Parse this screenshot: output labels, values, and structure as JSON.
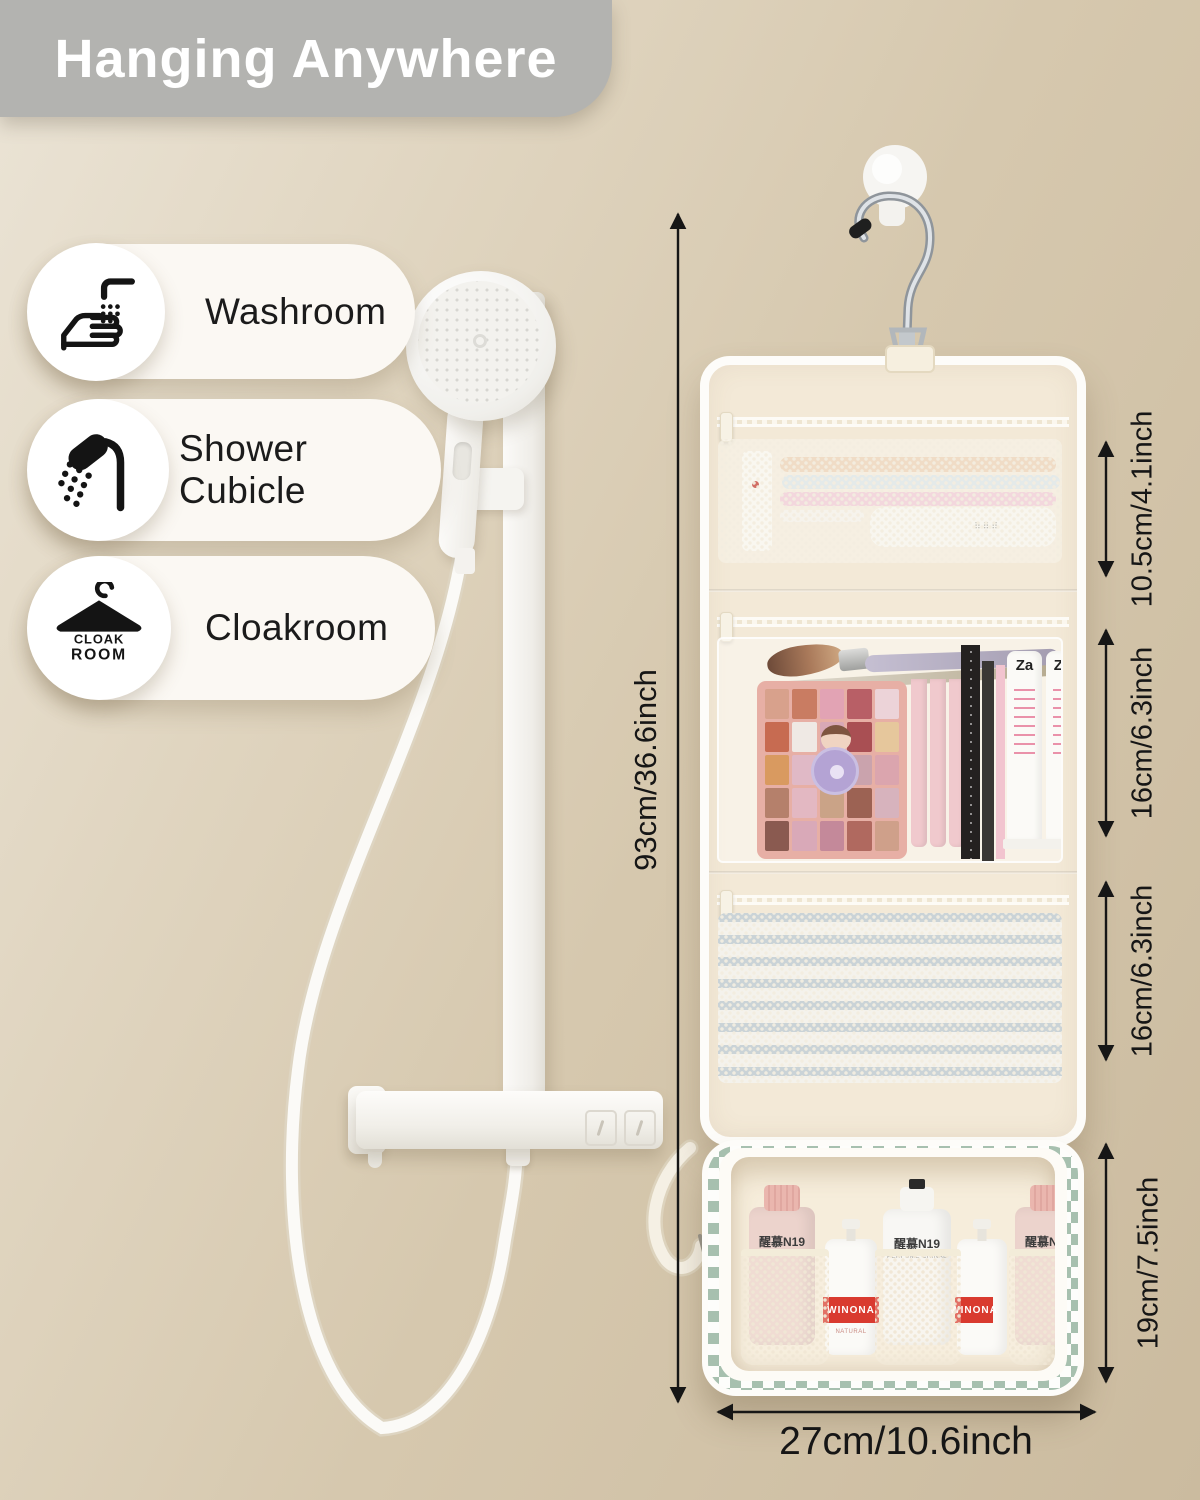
{
  "banner": {
    "title": "Hanging Anywhere"
  },
  "locations": [
    {
      "label": "Washroom"
    },
    {
      "label": "Shower Cubicle"
    },
    {
      "label": "Cloakroom"
    }
  ],
  "cloak_icon": {
    "line1": "CLOAK",
    "line2": "ROOM"
  },
  "dimensions": {
    "height_total": "93cm/36.6inch",
    "top_pocket": "10.5cm/4.1inch",
    "middle_pocket_upper": "16cm/6.3inch",
    "middle_pocket_lower": "16cm/6.3inch",
    "bottom_pouch": "19cm/7.5inch",
    "width": "27cm/10.6inch"
  },
  "organizer": {
    "bottles": [
      {
        "name": "醒慕N19",
        "sub": "PERFUME CRINAL",
        "style": "pink"
      },
      {
        "name": "WINONA",
        "sub": "NATURAL",
        "style": "pump"
      },
      {
        "name": "醒慕N19",
        "sub": "PERFUME CRINAL",
        "style": "white"
      },
      {
        "name": "WINONA",
        "sub": "",
        "style": "pump"
      },
      {
        "name": "醒慕N19",
        "sub": "PERFUME CRINAL",
        "style": "pink"
      }
    ],
    "tubes": [
      {
        "brand": "Za"
      },
      {
        "brand": "Za"
      }
    ],
    "toothbrush_dots": "⠿⠿⠿",
    "palette_swatches": [
      "#d8a18c",
      "#c97c62",
      "#e2a3b4",
      "#b85f66",
      "#ecd3d8",
      "#c76b51",
      "#efe9e4",
      "#d8a8b6",
      "#a94f53",
      "#e6c79c",
      "#d99a60",
      "#e0b9c6",
      "#8f5a4e",
      "#caa3ad",
      "#dba5ae",
      "#b5806b",
      "#e3b8c2",
      "#caa387",
      "#9c6253",
      "#d7b3bd",
      "#8a5a50",
      "#d9a9b8",
      "#c4899a",
      "#b0695f",
      "#cfa08a"
    ]
  },
  "colors": {
    "banner_gray": "#b3b3b0",
    "wall_beige": "#d8cab1",
    "checker_green": "#a7c0af",
    "stripe_blue": "#b9c7d0",
    "bottle_pink": "#ecd3cc",
    "brand_red": "#d93a2f",
    "dimension_line": "#161616"
  }
}
